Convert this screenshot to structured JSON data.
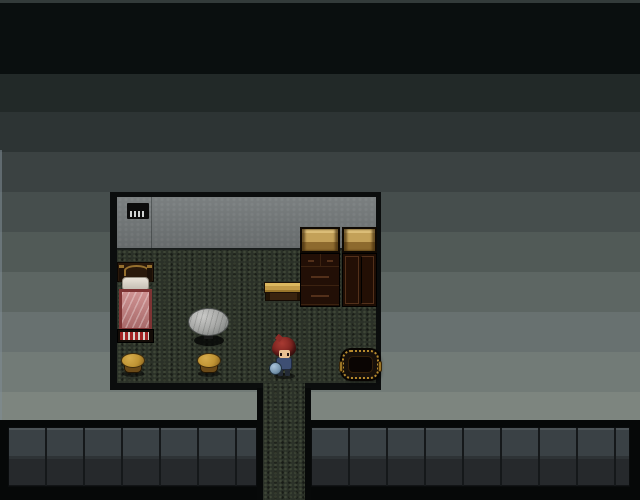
{
  "scene": {
    "type": "game-screenshot",
    "view": "top-down RPG room interior, dark banded exterior",
    "viewport_label": "game viewport 640x500"
  },
  "background": {
    "description": "horizontal gradient bands, near-black at top to light gray above the counters",
    "bands": [
      {
        "height": 3,
        "color": "#333b3a"
      },
      {
        "height": 71,
        "color": "#0a0f0f"
      },
      {
        "height": 38,
        "color": "#222928"
      },
      {
        "height": 40,
        "color": "#2d3434"
      },
      {
        "height": 40,
        "color": "#3b4242"
      },
      {
        "height": 40,
        "color": "#464e4d"
      },
      {
        "height": 40,
        "color": "#515a57"
      },
      {
        "height": 40,
        "color": "#5d6663"
      },
      {
        "height": 40,
        "color": "#687170"
      },
      {
        "height": 40,
        "color": "#727b77"
      },
      {
        "height": 28,
        "color": "#7d857f"
      }
    ]
  },
  "palette": {
    "edge-highlight": "#808d95",
    "bottom-base": "#060808",
    "counter-top": "#3a4145",
    "counter-bottom": "#26292c",
    "counter-highlight": "#4d5458",
    "counter-seam": "#15181a",
    "frame": "#0b0d0d",
    "wall": "#717677",
    "floor": "#2b3128",
    "sign": "#0c0c0c",
    "sign-mark": "#d2d5d4",
    "bed-headboard": "#2a190b",
    "bed-arch": "#96702e",
    "bed-pillow": "#ded8cd",
    "bed-blanket": "#bd8181",
    "bed-blanket-border": "#7e3434",
    "bed-stripe-red": "#a02424",
    "bed-stripe-white": "#d8d4cc",
    "table-top": "#a7a8a6",
    "table-base": "#101110",
    "stool-top": "#c09434",
    "stool-side": "#6b4a18",
    "bench-top": "#c29a48",
    "bench-front": "#39230f",
    "cabinet-shelf": "#c3a159",
    "cabinet-body": "#1d0d04",
    "cabinet-trim": "#53301a",
    "basket-rim": "#b68a2e",
    "basket-inner": "#0a0503",
    "char-hair": "#7c2420",
    "char-skin": "#e8c193",
    "char-outfit": "#3e4f73",
    "char-item": "#7795ad"
  },
  "room": {
    "label": "bedroom interior",
    "sign": {
      "label": "wall sign",
      "mark_count": 4
    }
  },
  "furniture": {
    "bed": {
      "label": "bed with red blanket"
    },
    "round_table": {
      "label": "round gray table"
    },
    "stool_left": {
      "label": "wooden stool"
    },
    "stool_right": {
      "label": "wooden stool"
    },
    "bench": {
      "label": "wooden bench"
    },
    "cabinet_drawers": {
      "label": "dresser with open shelf"
    },
    "cabinet_doors": {
      "label": "cupboard with open shelf"
    },
    "basket": {
      "label": "basket"
    }
  },
  "character": {
    "label": "player character facing down"
  }
}
